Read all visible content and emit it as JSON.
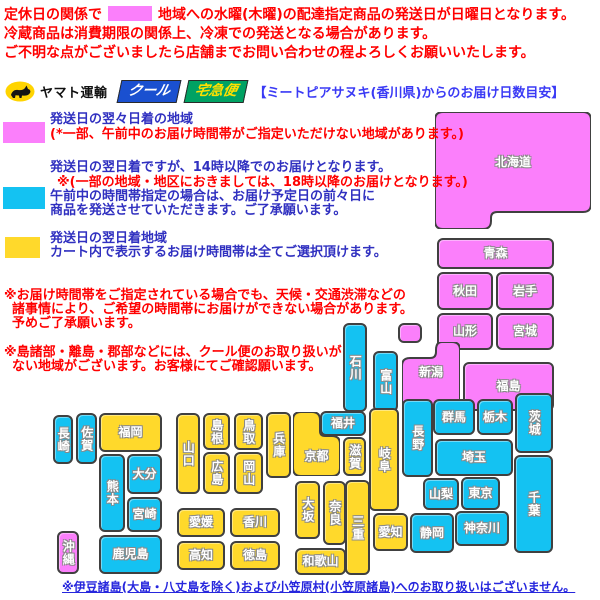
{
  "notice": {
    "line1_pre": "定休日の関係で",
    "line1_post": "地域への水曜(木曜)の配達指定商品の発送日が日曜日となります。",
    "line2": "冷蔵商品は消費期限の関係上、冷凍での発送となる場合があります。",
    "line3": "ご不明な点がございましたら店舗までお問い合わせの程よろしくお願いいたします。"
  },
  "logo": {
    "company": "ヤマト運輸",
    "cool": "クール",
    "takkyubin": "宅急便",
    "heading": "【ミートピアサヌキ(香川県)からのお届け日数目安】"
  },
  "legend": {
    "magenta_title": "発送日の翌々日着の地域",
    "magenta_note": "(*一部、午前中のお届け時間帯がご指定いただけない地域があります。)",
    "cyan_line1": "発送日の翌日着ですが、14時以降でのお届けとなります。",
    "cyan_note": "※(一部の地域・地区におきましては、18時以降のお届けとなります。)",
    "cyan_line2": "午前中の時間帯指定の場合は、お届け予定日の前々日に",
    "cyan_line3": "商品を発送させていただきます。ご了承願います。",
    "yellow_title": "発送日の翌日着地域",
    "yellow_line2": "カート内で表示するお届け時間帯は全てご選択頂けます。"
  },
  "notes": {
    "note1_line1": "※お届け時間帯をご指定されている場合でも、天候・交通渋滞などの",
    "note1_line2": "諸事情により、ご希望の時間帯にお届けができない場合があります。",
    "note1_line3": "予めご了承願います。",
    "note2_line1": "※島諸部・離島・郡部などには、クール便のお取り扱いが",
    "note2_line2": "ない地域がございます。お客様にてご確認願います。"
  },
  "footer": "※伊豆諸島(大島・八丈島を除く)および小笠原村(小笠原諸島)へのお取り扱いはございません。",
  "map": {
    "colors": {
      "2days": "#fb7ffb",
      "next14": "#14c2f2",
      "next": "#ffd92b"
    },
    "prefectures": [
      {
        "id": "hokkaido",
        "label": "北海道",
        "zone": "2days",
        "shape": "hokkaido",
        "x": 435,
        "y": 112,
        "w": 156,
        "h": 117,
        "lx": 435,
        "ly": 153,
        "lw": 156
      },
      {
        "id": "aomori",
        "label": "青森",
        "zone": "2days",
        "orient": "h",
        "x": 437,
        "y": 238,
        "w": 117,
        "h": 31
      },
      {
        "id": "akita",
        "label": "秋田",
        "zone": "2days",
        "orient": "h",
        "x": 437,
        "y": 272,
        "w": 56,
        "h": 38
      },
      {
        "id": "iwate",
        "label": "岩手",
        "zone": "2days",
        "orient": "h",
        "x": 496,
        "y": 272,
        "w": 58,
        "h": 38
      },
      {
        "id": "yamagata",
        "label": "山形",
        "zone": "2days",
        "orient": "h",
        "x": 437,
        "y": 313,
        "w": 56,
        "h": 37
      },
      {
        "id": "miyagi",
        "label": "宮城",
        "zone": "2days",
        "orient": "h",
        "x": 496,
        "y": 313,
        "w": 58,
        "h": 37
      },
      {
        "id": "sado",
        "label": "",
        "zone": "2days",
        "orient": "h",
        "x": 398,
        "y": 323,
        "w": 24,
        "h": 20
      },
      {
        "id": "niigata",
        "label": "新潟",
        "zone": "2days",
        "shape": "niigata",
        "x": 402,
        "y": 342,
        "w": 58,
        "h": 70,
        "lx": 402,
        "ly": 363,
        "lw": 58
      },
      {
        "id": "fukushima",
        "label": "福島",
        "zone": "2days",
        "orient": "h",
        "x": 463,
        "y": 362,
        "w": 91,
        "h": 49
      },
      {
        "id": "ishikawa",
        "label": "石川",
        "zone": "next14",
        "orient": "v",
        "x": 343,
        "y": 323,
        "w": 24,
        "h": 89
      },
      {
        "id": "toyama",
        "label": "富山",
        "zone": "next14",
        "orient": "v",
        "x": 373,
        "y": 351,
        "w": 25,
        "h": 61
      },
      {
        "id": "nagano",
        "label": "長野",
        "zone": "next14",
        "orient": "v",
        "x": 402,
        "y": 399,
        "w": 31,
        "h": 78
      },
      {
        "id": "gunma",
        "label": "群馬",
        "zone": "next14",
        "orient": "h",
        "x": 433,
        "y": 399,
        "w": 42,
        "h": 36
      },
      {
        "id": "tochigi",
        "label": "栃木",
        "zone": "next14",
        "orient": "h",
        "x": 477,
        "y": 399,
        "w": 36,
        "h": 36
      },
      {
        "id": "ibaraki",
        "label": "茨城",
        "zone": "next14",
        "orient": "v",
        "x": 515,
        "y": 393,
        "w": 38,
        "h": 60
      },
      {
        "id": "saitama",
        "label": "埼玉",
        "zone": "next14",
        "orient": "h",
        "x": 435,
        "y": 439,
        "w": 78,
        "h": 37
      },
      {
        "id": "yamanashi",
        "label": "山梨",
        "zone": "next14",
        "orient": "h",
        "x": 423,
        "y": 478,
        "w": 36,
        "h": 32
      },
      {
        "id": "tokyo",
        "label": "東京",
        "zone": "next14",
        "orient": "h",
        "x": 461,
        "y": 477,
        "w": 39,
        "h": 33
      },
      {
        "id": "chiba",
        "label": "千葉",
        "zone": "next14",
        "orient": "v",
        "x": 514,
        "y": 455,
        "w": 39,
        "h": 98
      },
      {
        "id": "kanagawa",
        "label": "神奈川",
        "zone": "next14",
        "orient": "h",
        "x": 455,
        "y": 511,
        "w": 54,
        "h": 35
      },
      {
        "id": "shizuoka",
        "label": "静岡",
        "zone": "next14",
        "orient": "h",
        "x": 410,
        "y": 513,
        "w": 44,
        "h": 40
      },
      {
        "id": "fukui",
        "label": "福井",
        "zone": "next14",
        "orient": "h",
        "x": 320,
        "y": 411,
        "w": 46,
        "h": 25
      },
      {
        "id": "kyoto",
        "label": "京都",
        "zone": "next",
        "shape": "kyoto",
        "x": 293,
        "y": 412,
        "w": 47,
        "h": 64,
        "lx": 293,
        "ly": 447,
        "lw": 47
      },
      {
        "id": "shiga",
        "label": "滋賀",
        "zone": "next",
        "orient": "v",
        "x": 343,
        "y": 437,
        "w": 23,
        "h": 39
      },
      {
        "id": "gifu",
        "label": "岐阜",
        "zone": "next",
        "orient": "v",
        "x": 369,
        "y": 408,
        "w": 30,
        "h": 103
      },
      {
        "id": "aichi",
        "label": "愛知",
        "zone": "next",
        "orient": "h",
        "x": 373,
        "y": 513,
        "w": 35,
        "h": 38
      },
      {
        "id": "mie",
        "label": "三重",
        "zone": "next",
        "orient": "v",
        "x": 345,
        "y": 480,
        "w": 25,
        "h": 95
      },
      {
        "id": "osaka",
        "label": "大坂",
        "zone": "next",
        "orient": "v",
        "x": 295,
        "y": 481,
        "w": 25,
        "h": 58
      },
      {
        "id": "nara",
        "label": "奈良",
        "zone": "next",
        "orient": "v",
        "x": 323,
        "y": 481,
        "w": 23,
        "h": 64
      },
      {
        "id": "wakayama",
        "label": "和歌山",
        "zone": "next",
        "orient": "h",
        "x": 295,
        "y": 548,
        "w": 51,
        "h": 27
      },
      {
        "id": "hyogo",
        "label": "兵庫",
        "zone": "next",
        "orient": "v",
        "x": 266,
        "y": 412,
        "w": 25,
        "h": 66
      },
      {
        "id": "tottori",
        "label": "鳥取",
        "zone": "next",
        "orient": "v",
        "x": 234,
        "y": 413,
        "w": 29,
        "h": 37
      },
      {
        "id": "okayama",
        "label": "岡山",
        "zone": "next",
        "orient": "v",
        "x": 234,
        "y": 452,
        "w": 29,
        "h": 42
      },
      {
        "id": "shimane",
        "label": "島根",
        "zone": "next",
        "orient": "v",
        "x": 203,
        "y": 413,
        "w": 27,
        "h": 37
      },
      {
        "id": "hiroshima",
        "label": "広島",
        "zone": "next",
        "orient": "v",
        "x": 203,
        "y": 452,
        "w": 27,
        "h": 42
      },
      {
        "id": "yamaguchi",
        "label": "山口",
        "zone": "next",
        "orient": "v",
        "x": 176,
        "y": 413,
        "w": 24,
        "h": 81
      },
      {
        "id": "kagawa",
        "label": "香川",
        "zone": "next",
        "orient": "h",
        "x": 230,
        "y": 508,
        "w": 50,
        "h": 29
      },
      {
        "id": "tokushima",
        "label": "徳島",
        "zone": "next",
        "orient": "h",
        "x": 230,
        "y": 541,
        "w": 50,
        "h": 29
      },
      {
        "id": "ehime",
        "label": "愛媛",
        "zone": "next",
        "orient": "h",
        "x": 177,
        "y": 508,
        "w": 48,
        "h": 29
      },
      {
        "id": "kochi",
        "label": "高知",
        "zone": "next",
        "orient": "h",
        "x": 177,
        "y": 541,
        "w": 48,
        "h": 29
      },
      {
        "id": "fukuoka",
        "label": "福岡",
        "zone": "next",
        "orient": "h",
        "x": 99,
        "y": 413,
        "w": 63,
        "h": 39
      },
      {
        "id": "saga",
        "label": "佐賀",
        "zone": "next14",
        "orient": "v",
        "x": 76,
        "y": 413,
        "w": 21,
        "h": 51
      },
      {
        "id": "nagasaki",
        "label": "長崎",
        "zone": "next14",
        "orient": "v",
        "x": 53,
        "y": 415,
        "w": 20,
        "h": 49
      },
      {
        "id": "oita",
        "label": "大分",
        "zone": "next14",
        "orient": "h",
        "x": 127,
        "y": 454,
        "w": 35,
        "h": 40
      },
      {
        "id": "kumamoto",
        "label": "熊本",
        "zone": "next14",
        "orient": "v",
        "x": 99,
        "y": 454,
        "w": 26,
        "h": 78
      },
      {
        "id": "miyazaki",
        "label": "宮崎",
        "zone": "next14",
        "orient": "h",
        "x": 127,
        "y": 497,
        "w": 35,
        "h": 35
      },
      {
        "id": "kagoshima",
        "label": "鹿児島",
        "zone": "next14",
        "orient": "h",
        "x": 99,
        "y": 535,
        "w": 63,
        "h": 39
      },
      {
        "id": "okinawa",
        "label": "沖縄",
        "zone": "2days",
        "orient": "v",
        "x": 57,
        "y": 531,
        "w": 22,
        "h": 43
      }
    ]
  }
}
